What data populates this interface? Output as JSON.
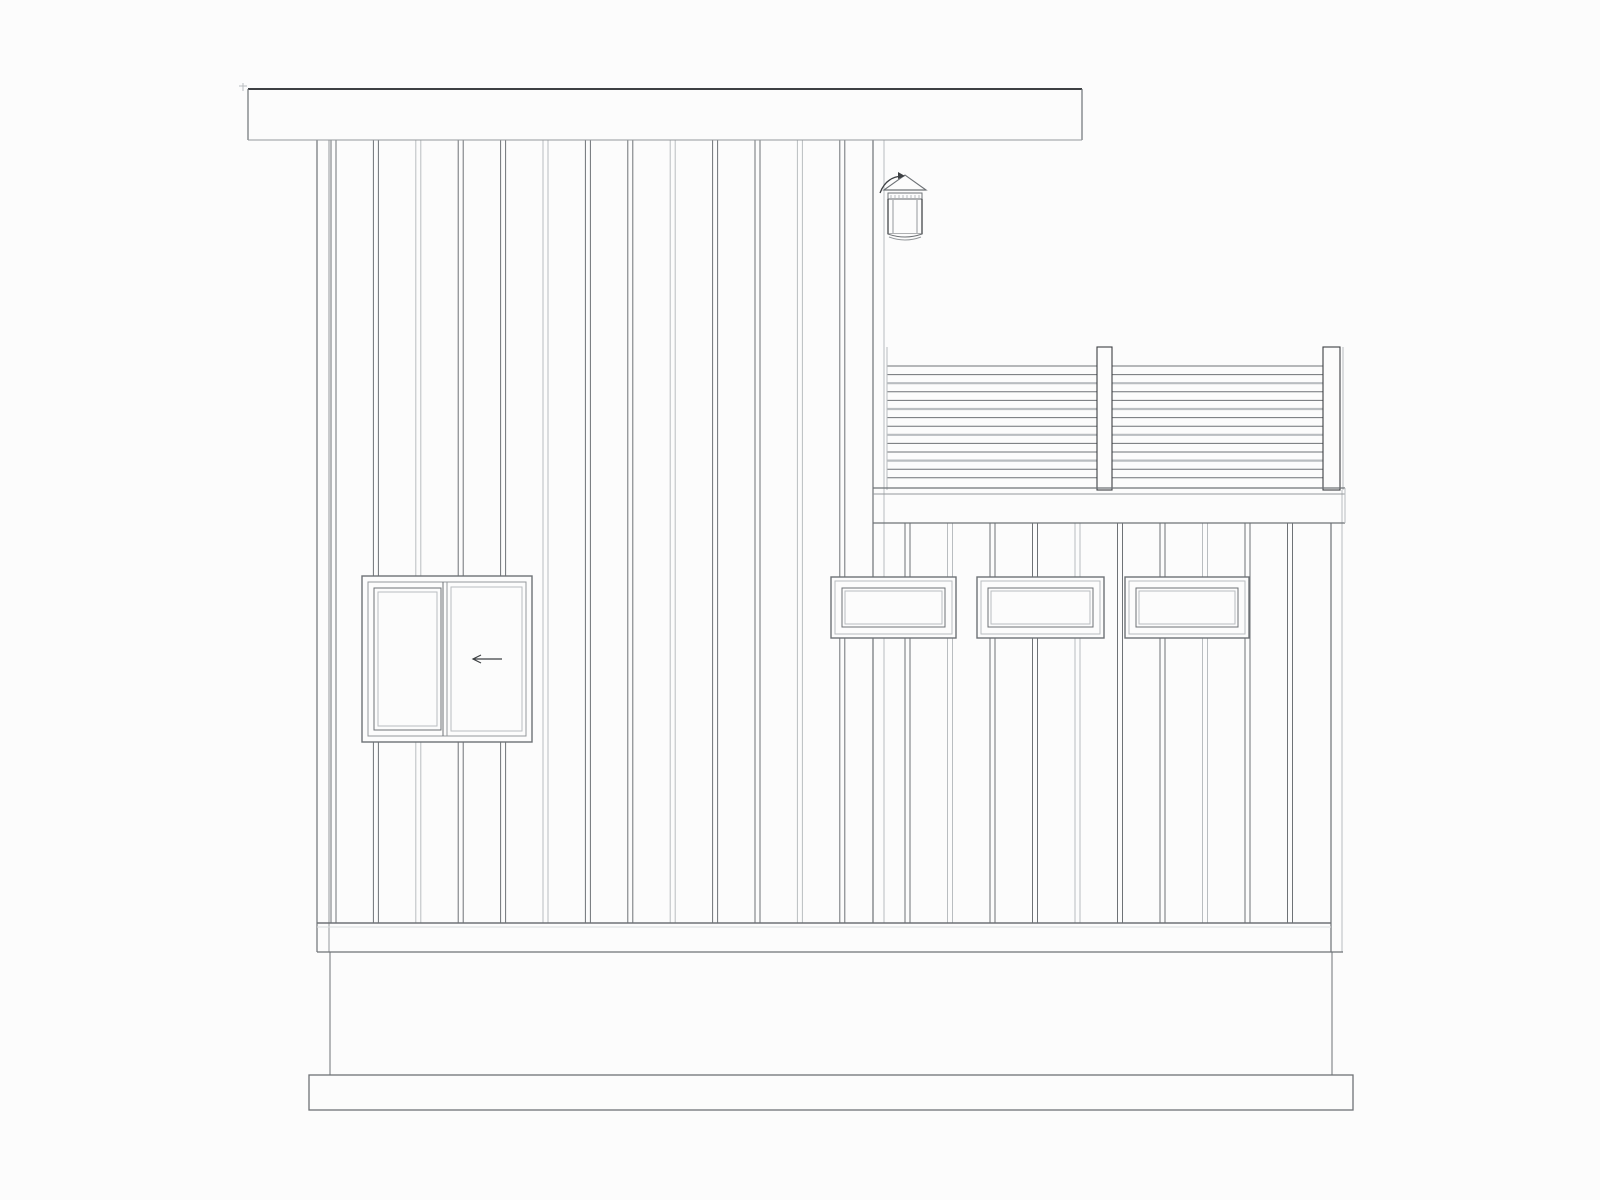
{
  "drawing": {
    "title": "side-elevation-line-drawing",
    "canvas": {
      "w": 1600,
      "h": 1200,
      "bg": "#fcfcfc"
    },
    "palette": {
      "dark": "#3d4043",
      "mid": "#6e7276",
      "soft": "#94989b",
      "light": "#b9bdc0",
      "faint": "#d9dcde"
    },
    "fascia": {
      "x": 248,
      "y": 89,
      "w": 834,
      "h": 51
    },
    "upper_wall": {
      "top": 138,
      "bottom": 923,
      "edge_left_outer": 317,
      "edge_left_inner": 329,
      "edge_right_dark": 873,
      "edge_right_light": 884,
      "batten_start": 331,
      "batten_pitch": 42.4,
      "batten_count": 13,
      "batten_width": 5
    },
    "lower_wall": {
      "top": 523,
      "bottom": 923,
      "edge_right_dark": 1331,
      "edge_right_light": 1342,
      "batten_start": 905,
      "batten_pitch": 42.5,
      "batten_count": 10,
      "batten_width": 5
    },
    "skirt_band": {
      "x1": 317,
      "x2": 1343,
      "y_top": 923,
      "y_shadow": 927,
      "y_bottom": 952
    },
    "foundation": {
      "x1": 330,
      "x2": 1332,
      "y1": 952,
      "y2": 1075
    },
    "plinth": {
      "x": 309,
      "y": 1075,
      "w": 1044,
      "h": 35
    },
    "big_window": {
      "x": 362,
      "y": 576,
      "w": 170,
      "h": 166,
      "inset": 6,
      "left_sash": {
        "x": 374,
        "y": 588,
        "w": 67,
        "h": 142,
        "inner_inset": 4
      },
      "mullion_x1": 443,
      "mullion_x2": 447,
      "right_sash": {
        "x": 451,
        "y": 587,
        "w": 71,
        "h": 144
      },
      "arrow": {
        "tail_x": 502,
        "tip_x": 473,
        "y": 659,
        "head": 8
      }
    },
    "small_windows": {
      "y": 577,
      "h": 61,
      "items": [
        {
          "x": 831,
          "w": 125
        },
        {
          "x": 977,
          "w": 127
        },
        {
          "x": 1125,
          "w": 124
        }
      ],
      "frames": [
        {
          "inset": 0,
          "tone": "mid",
          "sw": 1.4
        },
        {
          "inset": 4,
          "tone": "light",
          "sw": 1
        },
        {
          "inset": 11,
          "tone": "mid",
          "sw": 1
        },
        {
          "inset": 14,
          "tone": "light",
          "sw": 1
        }
      ]
    },
    "railing": {
      "rail_x1": 887,
      "rail_x2": 1327,
      "rails_y_first": 366,
      "rails_pitch": 8.6,
      "rails_count": 14,
      "post_top": 347,
      "post_bottom": 490,
      "mid_post": {
        "x": 1097,
        "w": 15
      },
      "end_post": {
        "x": 1323,
        "w": 17
      },
      "left_stile_x": 887,
      "deck_line_y1": 488,
      "deck_line_y2": 494,
      "deck_band_bottom": 523,
      "deck_x1": 873,
      "deck_x2": 1345,
      "gray_edge_x": 1343
    },
    "lantern": {
      "roof_x1": 884,
      "roof_x2": 926,
      "roof_base_y": 190,
      "apex_x": 905,
      "apex_y": 175,
      "arm": {
        "x1": 880,
        "y1": 193,
        "cx": 886,
        "cy": 177,
        "x2": 902,
        "y2": 176
      },
      "body": {
        "x": 888,
        "y": 193,
        "w": 34,
        "band_h": 6,
        "h": 41
      },
      "pane_x1": 893,
      "pane_x2": 917,
      "base_y": 234,
      "base_sag": 6
    },
    "corner_ticks": {
      "x": 244,
      "y": 88
    }
  }
}
